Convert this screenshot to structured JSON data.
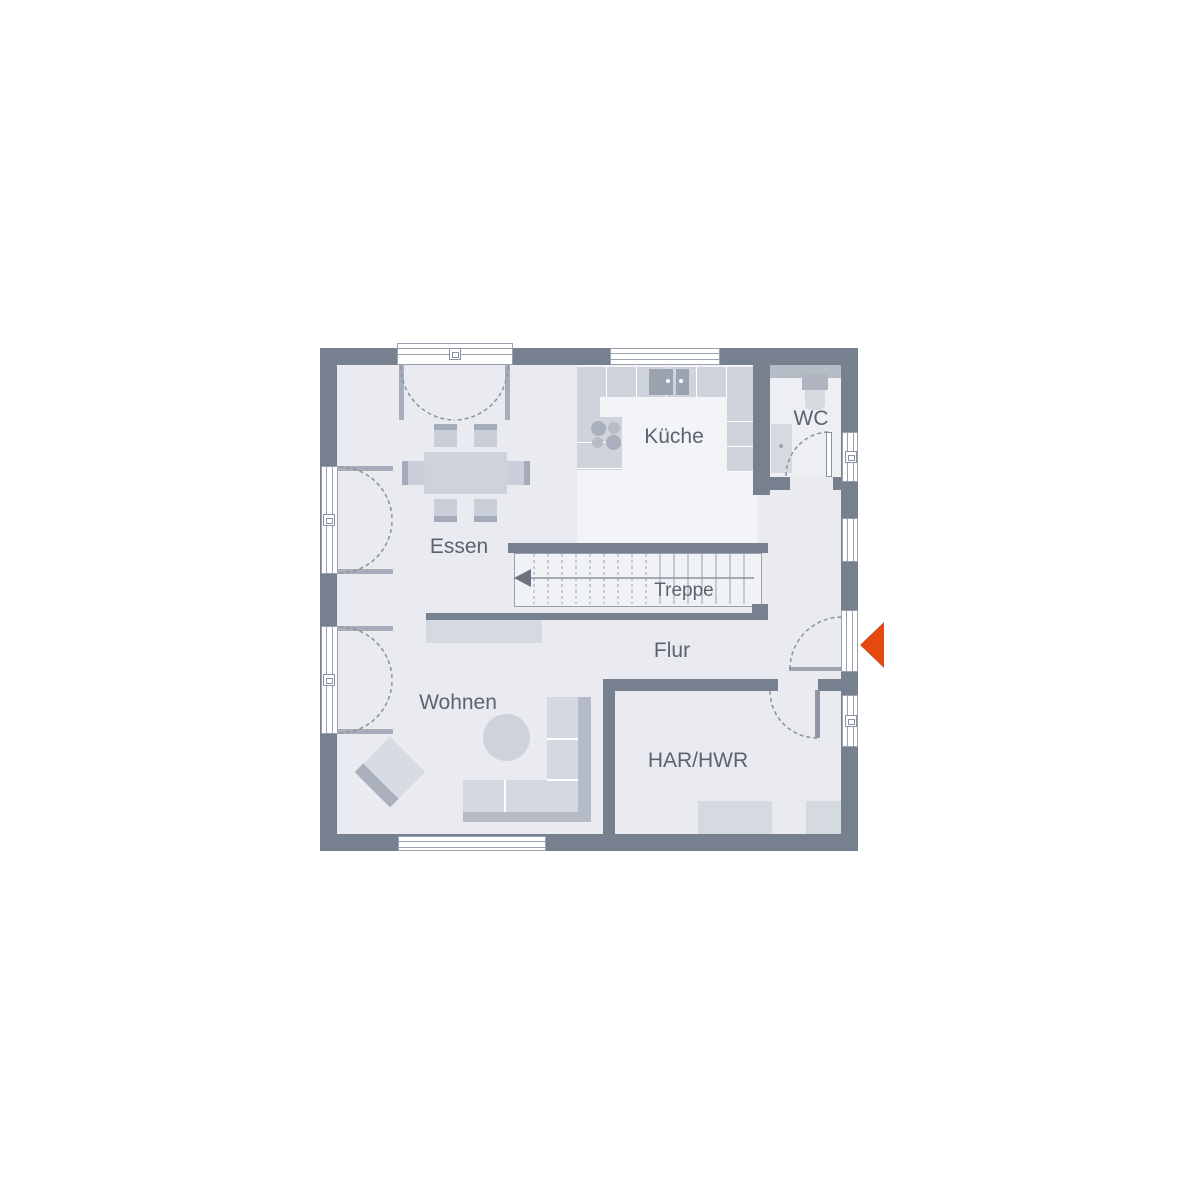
{
  "rooms": {
    "essen": "Essen",
    "kueche": "Küche",
    "wc": "WC",
    "treppe": "Treppe",
    "flur": "Flur",
    "wohnen": "Wohnen",
    "har_hwr": "HAR/HWR"
  },
  "icons": {
    "entrance_arrow": "orange-triangle-pointing-left-at-entry-door",
    "stairs_direction": "arrow-pointing-left-up-the-stairs"
  },
  "colors": {
    "wall": "#77808E",
    "floor": "#E9EBF0",
    "floor-light": "#F3F4F7",
    "floor-wc": "#EDEFF3",
    "stairs": "#F1F2F5",
    "furn-light": "#D5D9E0",
    "furn-mid": "#CDD2DB",
    "furn-dark": "#A9B0BC",
    "counter": "#CFD3DB",
    "sink": "#9BA3B1",
    "line": "#99A1AE",
    "accent": "#E5490F",
    "label": "#5A6370"
  }
}
